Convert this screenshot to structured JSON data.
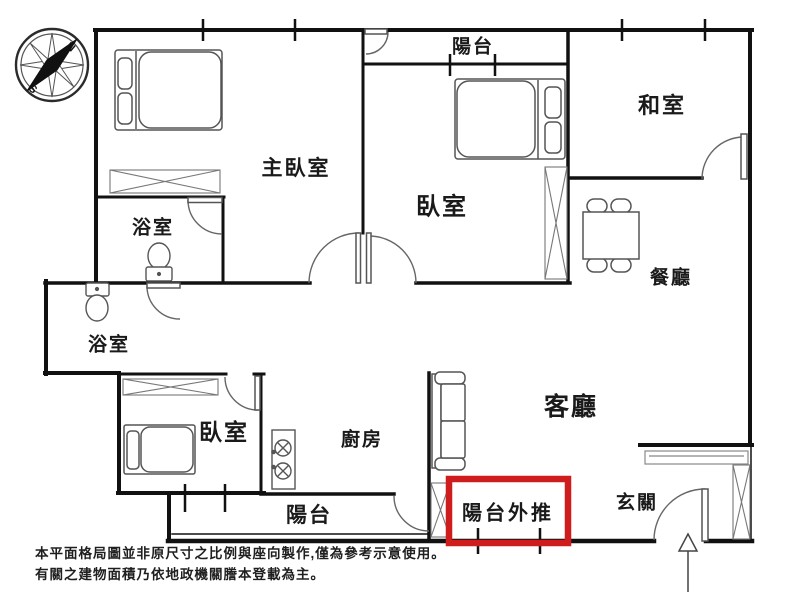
{
  "rooms": {
    "master_bedroom": "主臥室",
    "bedroom_upper": "臥室",
    "bedroom_lower": "臥室",
    "japanese_room": "和室",
    "bathroom_upper": "浴室",
    "bathroom_lower": "浴室",
    "dining_room": "餐廳",
    "kitchen": "廚房",
    "living_room": "客廳",
    "balcony_top": "陽台",
    "balcony_bottom": "陽台",
    "balcony_extension": "陽台外推",
    "entryway": "玄關"
  },
  "compass": {
    "north_label": "N",
    "south_label": "S"
  },
  "colors": {
    "highlight_red": "#cf1d1d",
    "wall_black": "#111111"
  },
  "disclaimer": {
    "line1": "本平面格局圖並非原尺寸之比例與座向製作,僅為參考示意使用。",
    "line2": "有關之建物面積乃依地政機關謄本登載為主。"
  }
}
